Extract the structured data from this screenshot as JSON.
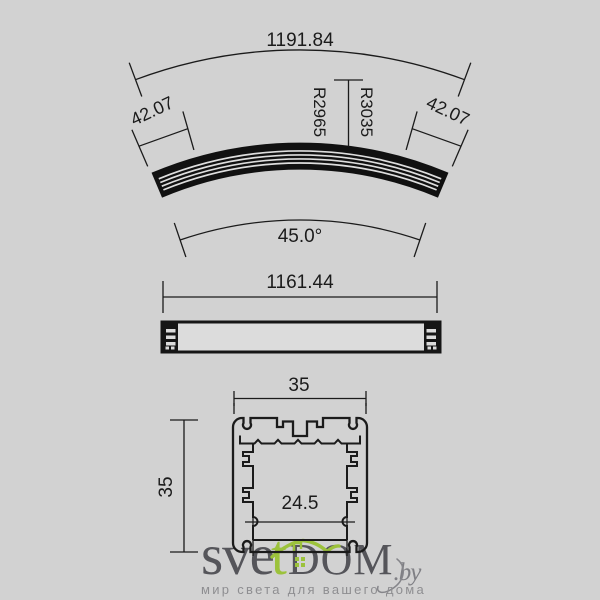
{
  "background_color": "#d2d2d2",
  "line_color": "#1b1b1b",
  "views": {
    "curved_profile": {
      "arc_length_label": "1191.84",
      "end_width_left_label": "42.07",
      "end_width_right_label": "42.07",
      "radius_inner_label": "R2965",
      "radius_outer_label": "R3035",
      "angle_label": "45.0°"
    },
    "side_profile": {
      "length_label": "1161.44"
    },
    "cross_section": {
      "width_label": "35",
      "height_label": "35",
      "inner_width_label": "24.5"
    }
  },
  "watermark": {
    "brand_part1": "sve",
    "brand_t": "t",
    "brand_part2": "DOM",
    "brand_suffix": ".by",
    "tagline": "мир света для вашего дома",
    "green": "#9cc23c",
    "text_color": "#55555a"
  }
}
